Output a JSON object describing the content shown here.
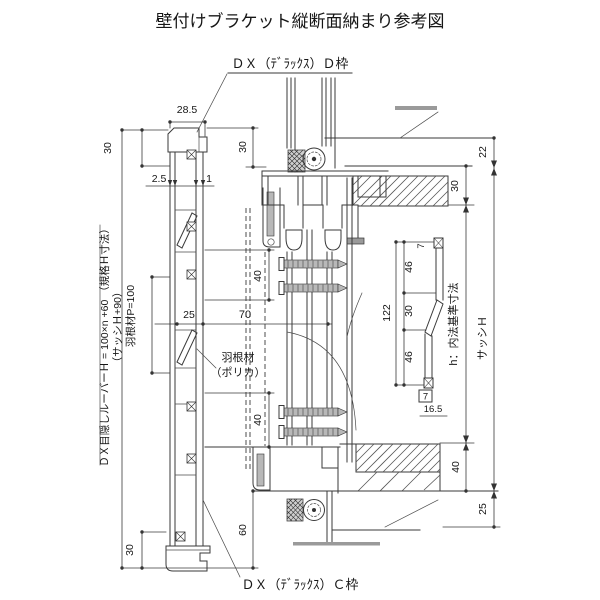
{
  "title": "壁付けブラケット縦断面納まり参考図",
  "annotations": {
    "top_frame": "ＤＸ（ﾃﾞﾗｯｸｽ）Ｄ枠",
    "bottom_frame": "ＤＸ（ﾃﾞﾗｯｸｽ）Ｃ枠",
    "blade_label_line1": "羽根材",
    "blade_label_line2": "（ポリカ）",
    "left_formula": "ＤＸ目隠しルーバーＨ = 100×n +60 （規格Ｈ寸法）",
    "left_sub": "（サッシＨ+90）",
    "blade_pitch": "羽根材P=100",
    "right_inner_standard": "h：内法基準寸法",
    "right_sash_height": "サッシＨ"
  },
  "dimensions": {
    "cap_width": "28.5",
    "top_left": "30",
    "top_center": "30",
    "thickness": "2.5",
    "lip": "1",
    "depth": "25",
    "offset": "70",
    "upper_span": "40",
    "lower_span": "40",
    "bottom_left": "30",
    "bottom_center": "60",
    "right_offset_top": "22",
    "right_top": "30",
    "right_bottom": "40",
    "right_offset_bottom": "25",
    "detail_top": "7",
    "detail_upper": "46",
    "detail_mid": "30",
    "detail_lower": "46",
    "detail_total": "122",
    "detail_bottom": "7",
    "detail_base": "16.5"
  }
}
